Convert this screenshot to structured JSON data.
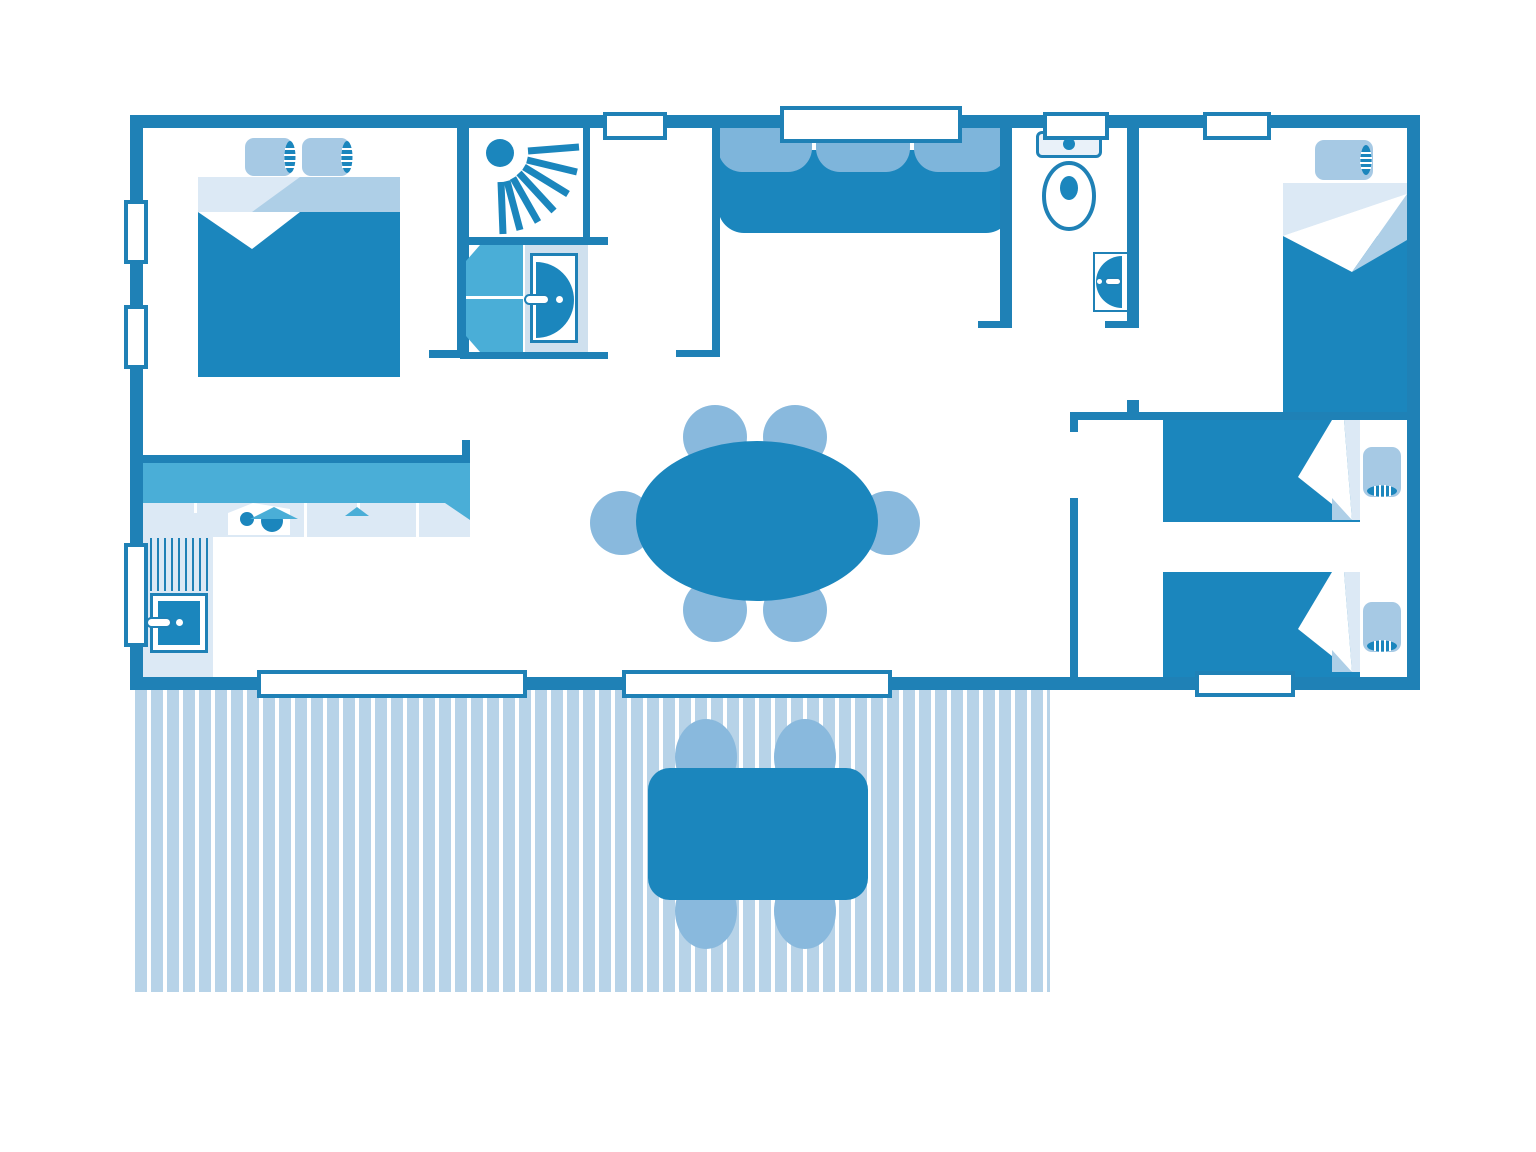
{
  "document": {
    "type": "floor-plan",
    "visible_text": [],
    "colors": {
      "wall": "#1f81b6",
      "dark": "#1b86bd",
      "mid": "#4aaed7",
      "cushion": "#7eb5db",
      "chair": "#89b9dd",
      "pillow": "#a6c9e4",
      "sheet1": "#dce9f5",
      "sheet2": "#aecfe7",
      "deck": "#b7d3e8",
      "fixture": "#cfe0ee",
      "tank": "#e9f1f9"
    },
    "icons": [
      "shower-spray-icon",
      "washbasin-icon",
      "toilet-icon",
      "stove-burners-icon",
      "kitchen-sink-icon",
      "double-bed-icon",
      "single-bed-icon",
      "sofa-icon",
      "dining-table-icon",
      "terrace-table-icon",
      "window-icon",
      "wardrobe-icon"
    ],
    "rooms": [
      "master-bedroom",
      "shower-room",
      "entrance-hall",
      "living-room",
      "kitchen",
      "wc",
      "single-bedroom",
      "twin-bedroom",
      "terrace"
    ],
    "counts": {
      "double_beds": 1,
      "single_beds": 3,
      "dining_chairs": 6,
      "terrace_chairs": 4,
      "windows": 10,
      "washbasins": 3
    }
  }
}
